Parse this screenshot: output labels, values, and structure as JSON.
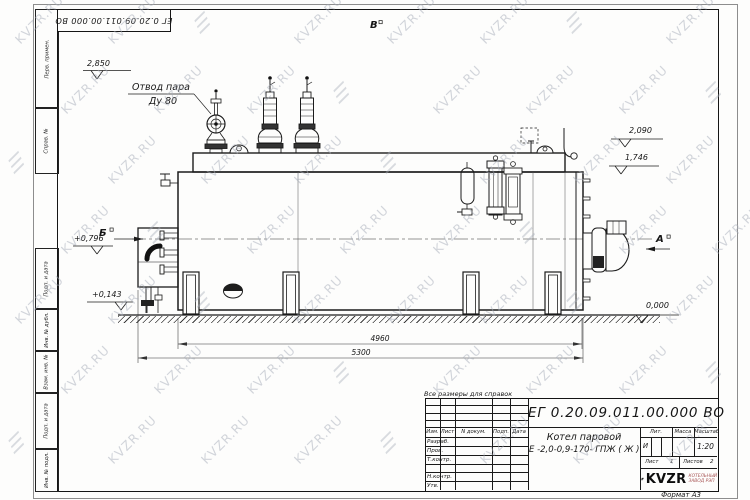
{
  "watermark": {
    "text": "KVZR.RU"
  },
  "sheet": {
    "corner_stamp": "ЕГ 0.20.09.011.00.000  ВО",
    "format_label": "Формат А3",
    "note": "Все размеры для справок",
    "margin_labels": [
      "Перв. примен.",
      "Справ. №",
      "Подп. и дата",
      "Инв. № дубл.",
      "Взам. инв. №",
      "Подп. и дата",
      "Инв. № подл."
    ]
  },
  "drawing": {
    "callout": {
      "line1": "Отвод пара",
      "line2": "Ду 80"
    },
    "elevations": {
      "top": "2,850",
      "right_upper": "2,090",
      "right_lower": "1,746",
      "left_upper": "+0,796",
      "left_lower": "+0,143",
      "ground": "0,000"
    },
    "views": {
      "top": "В",
      "left": "Б",
      "right": "А"
    },
    "dimensions": {
      "inner": "4960",
      "overall": "5300"
    }
  },
  "title_block": {
    "doc_number": "ЕГ 0.20.09.011.00.000  ВО",
    "name_line1": "Котел паровой",
    "name_line2": "Е -2,0-0,9-170- ГПЖ ( Ж )",
    "header": [
      "Изм.",
      "Лист",
      "N докум.",
      "Подп.",
      "Дата"
    ],
    "sign_rows": [
      "Разраб.",
      "Пров.",
      "Т.контр.",
      "Н.контр.",
      "Утв."
    ],
    "lit_label": "Лит.",
    "mass_label": "Масса",
    "scale_label": "Масштаб",
    "lit_value": "И",
    "scale_value": "1:20",
    "sheet_label": "Лист",
    "sheet_no": "1",
    "sheets_label": "Листов",
    "sheets_total": "2",
    "brand": "KVZR",
    "brand_line1": "КОТЕЛЬНЫЙ",
    "brand_line2": "ЗАВОД РЭП"
  }
}
